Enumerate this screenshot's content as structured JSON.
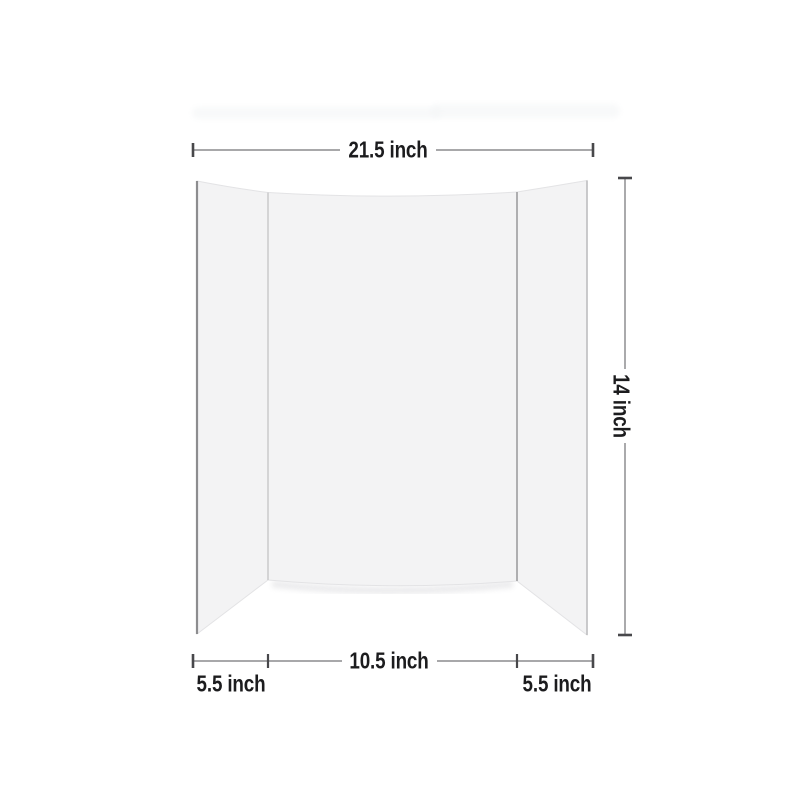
{
  "labels": {
    "total_width": "21.5 inch",
    "height": "14 inch",
    "center_panel_width": "10.5 inch",
    "left_wing_width": "5.5 inch",
    "right_wing_width": "5.5 inch"
  },
  "colors": {
    "background": "#ffffff",
    "board_fill": "#f3f3f4",
    "board_outline": "#e3e3e5",
    "left_edge": "#8d8d8f",
    "fold_line_left": "#cccccd",
    "fold_line_right": "#a6a6a8",
    "right_edge": "#bdbdbf",
    "panel_shadow": "#e7e7e9",
    "artifact_band": "#f4f6f7",
    "dimension_line": "#9b9b9e",
    "dimension_tick": "#48484b",
    "label_text": "#1c1c1e"
  }
}
